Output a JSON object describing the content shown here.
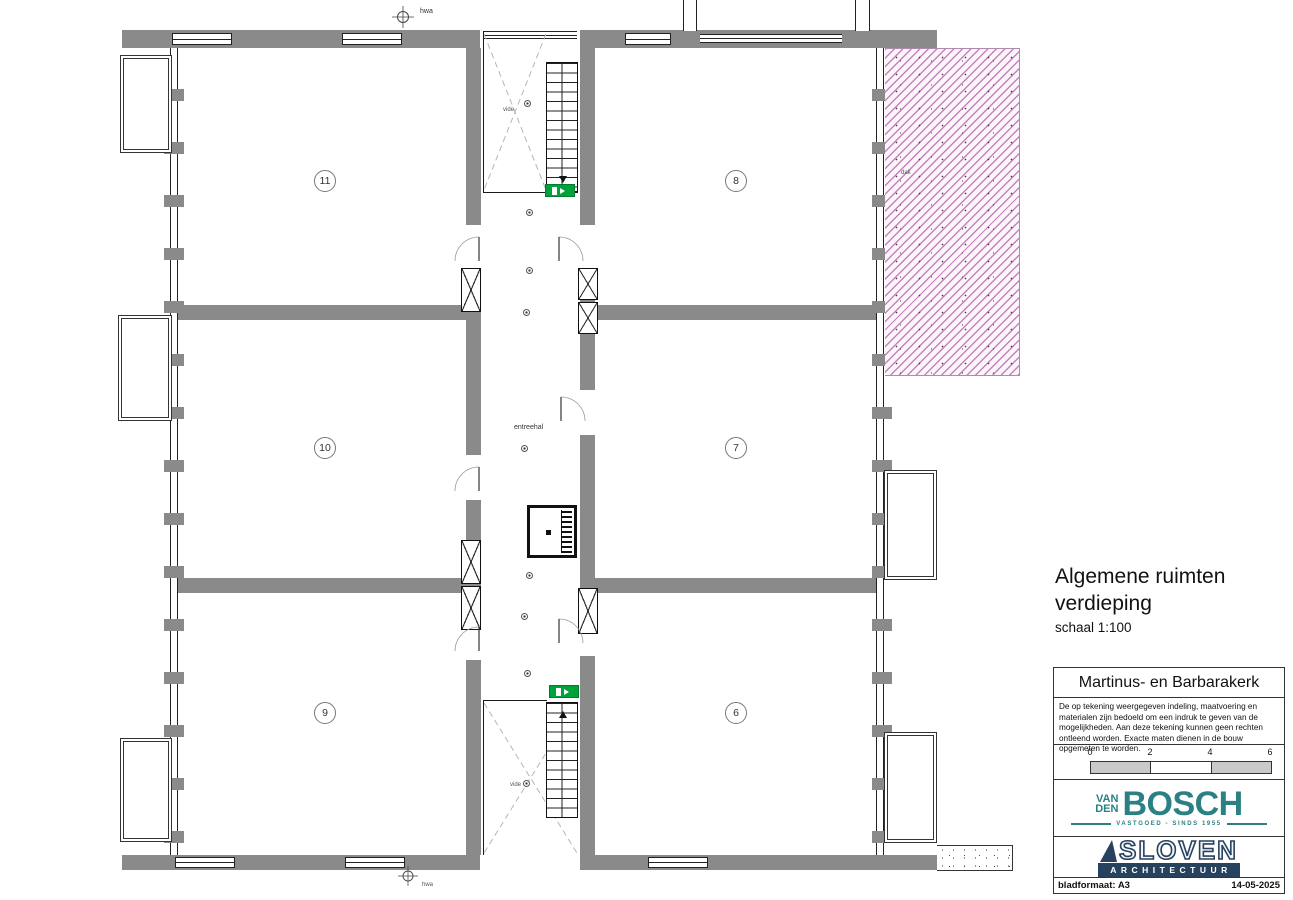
{
  "drawing": {
    "title_line1": "Algemene ruimten",
    "title_line2": "verdieping",
    "scale_note": "schaal 1:100",
    "rooms": [
      {
        "number": "11"
      },
      {
        "number": "10"
      },
      {
        "number": "9"
      },
      {
        "number": "8"
      },
      {
        "number": "7"
      },
      {
        "number": "6"
      }
    ],
    "labels": {
      "entreehal": "entreehal",
      "vide": "vide",
      "hwa": "hwa",
      "dak": "dak"
    }
  },
  "title_block": {
    "project": "Martinus- en Barbarakerk",
    "disclaimer": "De op tekening weergegeven indeling, maatvoering en materialen zijn bedoeld om een indruk te geven van de mogelijkheden. Aan deze tekening kunnen geen rechten ontleend worden. Exacte maten dienen in de bouw opgemeten te worden.",
    "scale_bar": {
      "ticks": [
        "0",
        "2",
        "4",
        "6"
      ]
    },
    "logo_vandenbosch": {
      "line1": "VAN",
      "line2": "DEN",
      "name": "BOSCH",
      "tagline": "VASTGOED - SINDS 1955"
    },
    "logo_sloven": {
      "name": "SLOVEN",
      "subtitle": "ARCHITECTUUR"
    },
    "footer_left": "bladformaat: A3",
    "footer_right": "14-05-2025"
  },
  "colors": {
    "wall_gray": "#8a8a8a",
    "hatch_pink": "#c583bd",
    "exit_green": "#00a33a",
    "vdb_teal": "#2a8083",
    "sloven_navy": "#27425f"
  }
}
